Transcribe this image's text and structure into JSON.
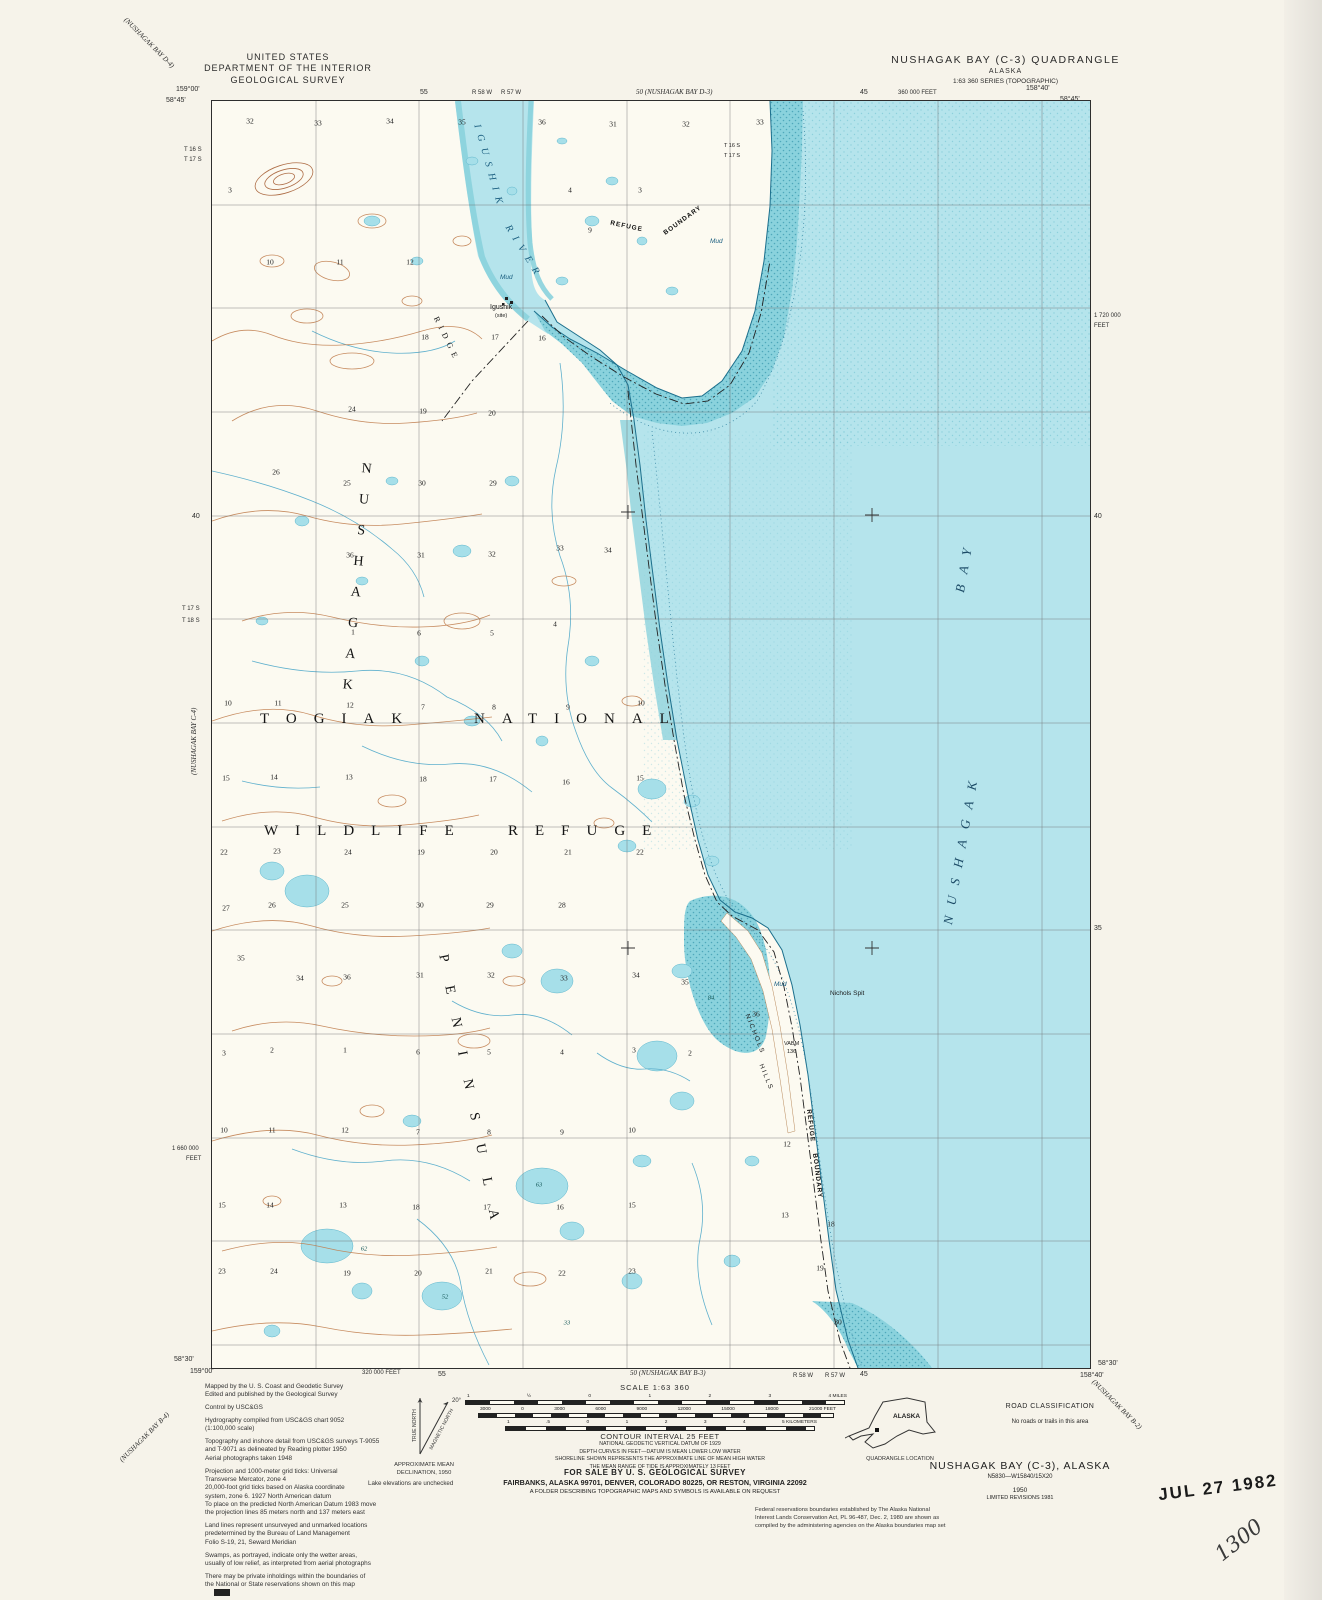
{
  "header": {
    "agency_line1": "UNITED STATES",
    "agency_line2": "DEPARTMENT OF THE INTERIOR",
    "agency_line3": "GEOLOGICAL SURVEY",
    "quad_title": "NUSHAGAK BAY (C-3) QUADRANGLE",
    "quad_state": "ALASKA",
    "quad_series": "1:63 360 SERIES (TOPOGRAPHIC)"
  },
  "edges": {
    "top_left_adjoining": "(NUSHAGAK BAY D-4)",
    "top_left_lon": "159°00'",
    "top_left_lat": "58°45'",
    "top_tick_55": "55",
    "top_range_1": "R 58 W",
    "top_range_2": "R 57 W",
    "top_center_adjoining": "50 (NUSHAGAK BAY D-3)",
    "top_tick_45": "45",
    "top_feet": "360 000 FEET",
    "top_right_lon": "158°40'",
    "top_right_lat": "58°45'",
    "left_township_1": "T 16 S",
    "left_township_2": "T 17 S",
    "left_tick_40": "40",
    "left_township_3": "T 17 S",
    "left_township_4": "T 18 S",
    "left_adjoining": "(NUSHAGAK BAY C-4)",
    "left_feet_1": "1 660 000",
    "left_feet_2": "FEET",
    "right_feet_1": "1 720 000",
    "right_feet_2": "FEET",
    "right_tick_40": "40",
    "right_tick_35": "35",
    "bottom_left_lat": "58°30'",
    "bottom_left_lon": "159°00'",
    "bottom_left_adjoining": "(NUSHAGAK BAY B-4)",
    "bottom_feet": "320 000 FEET",
    "bottom_tick_55": "55",
    "bottom_center_adjoining": "50 (NUSHAGAK BAY B-3)",
    "bottom_range_1": "R 58 W",
    "bottom_range_2": "R 57 W",
    "bottom_tick_45": "45",
    "bottom_right_lon": "158°40'",
    "bottom_right_lat": "58°30'",
    "bottom_right_adjoining": "(NUSHAGAK BAY B-2)",
    "imprint": "INTERIOR—GEOLOGICAL SURVEY, RESTON, VIRGINIA—1981"
  },
  "map": {
    "area_label_1": "TOGIAK",
    "area_label_2": "NATIONAL",
    "area_label_3": "WILDLIFE",
    "area_label_4": "REFUGE",
    "peninsula_label_1": "NUSHAGAK",
    "peninsula_label_2": "PENINSULA",
    "bay_label_1": "NUSHAGAK",
    "bay_label_2": "BAY",
    "river_label_1": "IGUSHIK",
    "river_label_2": "RIVER",
    "ridge_label": "RIDGE",
    "boundary_top_1": "REFUGE",
    "boundary_top_2": "BOUNDARY",
    "boundary_coast_1": "REFUGE",
    "boundary_coast_2": "BOUNDARY",
    "nichols_spit": "Nichols Spit",
    "nichols_hills_1": "NICHOLS",
    "nichols_hills_2": "HILLS",
    "vabm_line1": "VABM",
    "vabm_line2": "136",
    "site_name": "Igushik",
    "site_type": "(site)",
    "mud_label": "Mud",
    "township_inside_1": "T 16 S",
    "township_inside_2": "T 17 S",
    "sections": [
      {
        "n": "32",
        "x": 38,
        "y": 20
      },
      {
        "n": "33",
        "x": 106,
        "y": 22
      },
      {
        "n": "34",
        "x": 178,
        "y": 20
      },
      {
        "n": "35",
        "x": 250,
        "y": 21
      },
      {
        "n": "36",
        "x": 330,
        "y": 21
      },
      {
        "n": "31",
        "x": 401,
        "y": 23
      },
      {
        "n": "32",
        "x": 474,
        "y": 23
      },
      {
        "n": "33",
        "x": 548,
        "y": 21
      },
      {
        "n": "3",
        "x": 18,
        "y": 89
      },
      {
        "n": "4",
        "x": 358,
        "y": 89
      },
      {
        "n": "3",
        "x": 428,
        "y": 89
      },
      {
        "n": "9",
        "x": 378,
        "y": 129
      },
      {
        "n": "10",
        "x": 58,
        "y": 161
      },
      {
        "n": "11",
        "x": 128,
        "y": 161
      },
      {
        "n": "12",
        "x": 198,
        "y": 161
      },
      {
        "n": "18",
        "x": 213,
        "y": 236
      },
      {
        "n": "17",
        "x": 283,
        "y": 236
      },
      {
        "n": "16",
        "x": 330,
        "y": 237
      },
      {
        "n": "24",
        "x": 140,
        "y": 308
      },
      {
        "n": "19",
        "x": 211,
        "y": 310
      },
      {
        "n": "20",
        "x": 280,
        "y": 312
      },
      {
        "n": "26",
        "x": 64,
        "y": 371
      },
      {
        "n": "25",
        "x": 135,
        "y": 382
      },
      {
        "n": "30",
        "x": 210,
        "y": 382
      },
      {
        "n": "29",
        "x": 281,
        "y": 382
      },
      {
        "n": "36",
        "x": 138,
        "y": 454
      },
      {
        "n": "31",
        "x": 209,
        "y": 454
      },
      {
        "n": "32",
        "x": 280,
        "y": 453
      },
      {
        "n": "33",
        "x": 348,
        "y": 447
      },
      {
        "n": "34",
        "x": 396,
        "y": 449
      },
      {
        "n": "1",
        "x": 141,
        "y": 531
      },
      {
        "n": "6",
        "x": 207,
        "y": 532
      },
      {
        "n": "5",
        "x": 280,
        "y": 532
      },
      {
        "n": "4",
        "x": 343,
        "y": 523
      },
      {
        "n": "10",
        "x": 16,
        "y": 602
      },
      {
        "n": "11",
        "x": 66,
        "y": 602
      },
      {
        "n": "12",
        "x": 138,
        "y": 604
      },
      {
        "n": "7",
        "x": 211,
        "y": 606
      },
      {
        "n": "8",
        "x": 282,
        "y": 606
      },
      {
        "n": "9",
        "x": 356,
        "y": 606
      },
      {
        "n": "10",
        "x": 429,
        "y": 602
      },
      {
        "n": "15",
        "x": 14,
        "y": 677
      },
      {
        "n": "14",
        "x": 62,
        "y": 676
      },
      {
        "n": "13",
        "x": 137,
        "y": 676
      },
      {
        "n": "18",
        "x": 211,
        "y": 678
      },
      {
        "n": "17",
        "x": 281,
        "y": 678
      },
      {
        "n": "16",
        "x": 354,
        "y": 681
      },
      {
        "n": "15",
        "x": 428,
        "y": 677
      },
      {
        "n": "22",
        "x": 12,
        "y": 751
      },
      {
        "n": "23",
        "x": 65,
        "y": 750
      },
      {
        "n": "24",
        "x": 136,
        "y": 751
      },
      {
        "n": "19",
        "x": 209,
        "y": 751
      },
      {
        "n": "20",
        "x": 282,
        "y": 751
      },
      {
        "n": "21",
        "x": 356,
        "y": 751
      },
      {
        "n": "22",
        "x": 428,
        "y": 751
      },
      {
        "n": "27",
        "x": 14,
        "y": 807
      },
      {
        "n": "26",
        "x": 60,
        "y": 804
      },
      {
        "n": "25",
        "x": 133,
        "y": 804
      },
      {
        "n": "30",
        "x": 208,
        "y": 804
      },
      {
        "n": "29",
        "x": 278,
        "y": 804
      },
      {
        "n": "28",
        "x": 350,
        "y": 804
      },
      {
        "n": "35",
        "x": 29,
        "y": 857
      },
      {
        "n": "34",
        "x": 88,
        "y": 877
      },
      {
        "n": "36",
        "x": 135,
        "y": 876
      },
      {
        "n": "31",
        "x": 208,
        "y": 874
      },
      {
        "n": "32",
        "x": 279,
        "y": 874
      },
      {
        "n": "33",
        "x": 352,
        "y": 877
      },
      {
        "n": "34",
        "x": 424,
        "y": 874
      },
      {
        "n": "35",
        "x": 473,
        "y": 881
      },
      {
        "n": "36",
        "x": 544,
        "y": 913
      },
      {
        "n": "3",
        "x": 12,
        "y": 952
      },
      {
        "n": "2",
        "x": 60,
        "y": 949
      },
      {
        "n": "1",
        "x": 133,
        "y": 949
      },
      {
        "n": "6",
        "x": 206,
        "y": 951
      },
      {
        "n": "5",
        "x": 277,
        "y": 951
      },
      {
        "n": "4",
        "x": 350,
        "y": 951
      },
      {
        "n": "3",
        "x": 422,
        "y": 949
      },
      {
        "n": "2",
        "x": 478,
        "y": 952
      },
      {
        "n": "10",
        "x": 12,
        "y": 1029
      },
      {
        "n": "11",
        "x": 60,
        "y": 1029
      },
      {
        "n": "12",
        "x": 133,
        "y": 1029
      },
      {
        "n": "7",
        "x": 206,
        "y": 1031
      },
      {
        "n": "8",
        "x": 277,
        "y": 1031
      },
      {
        "n": "9",
        "x": 350,
        "y": 1031
      },
      {
        "n": "10",
        "x": 420,
        "y": 1029
      },
      {
        "n": "12",
        "x": 575,
        "y": 1043
      },
      {
        "n": "15",
        "x": 10,
        "y": 1104
      },
      {
        "n": "14",
        "x": 58,
        "y": 1104
      },
      {
        "n": "13",
        "x": 131,
        "y": 1104
      },
      {
        "n": "18",
        "x": 204,
        "y": 1106
      },
      {
        "n": "17",
        "x": 275,
        "y": 1106
      },
      {
        "n": "16",
        "x": 348,
        "y": 1106
      },
      {
        "n": "15",
        "x": 420,
        "y": 1104
      },
      {
        "n": "13",
        "x": 573,
        "y": 1114
      },
      {
        "n": "18",
        "x": 619,
        "y": 1123
      },
      {
        "n": "23",
        "x": 10,
        "y": 1170
      },
      {
        "n": "24",
        "x": 62,
        "y": 1170
      },
      {
        "n": "19",
        "x": 135,
        "y": 1172
      },
      {
        "n": "20",
        "x": 206,
        "y": 1172
      },
      {
        "n": "21",
        "x": 277,
        "y": 1170
      },
      {
        "n": "22",
        "x": 350,
        "y": 1172
      },
      {
        "n": "23",
        "x": 420,
        "y": 1170
      },
      {
        "n": "19",
        "x": 608,
        "y": 1167
      },
      {
        "n": "30",
        "x": 626,
        "y": 1221
      }
    ],
    "spot_elevations": [
      {
        "v": "84",
        "x": 499,
        "y": 897
      },
      {
        "v": "62",
        "x": 152,
        "y": 1148
      },
      {
        "v": "63",
        "x": 327,
        "y": 1084
      },
      {
        "v": "52",
        "x": 233,
        "y": 1196
      },
      {
        "v": "33",
        "x": 355,
        "y": 1222
      }
    ]
  },
  "footer": {
    "scale_label": "SCALE 1:63 360",
    "miles_labels": [
      "1",
      "½",
      "0",
      "1",
      "2",
      "3",
      "4 MILES"
    ],
    "feet_labels": [
      "3000",
      "0",
      "3000",
      "6000",
      "9000",
      "12000",
      "15000",
      "18000",
      "21000 FEET"
    ],
    "km_labels": [
      "1",
      ".5",
      "0",
      "1",
      "2",
      "3",
      "4",
      "5 KILOMETERS"
    ],
    "contour_lines": [
      "NATIONAL GEODETIC VERTICAL DATUM OF 1929",
      "DEPTH CURVES IN FEET—DATUM IS MEAN LOWER LOW WATER",
      "SHORELINE SHOWN REPRESENTS THE APPROXIMATE LINE OF MEAN HIGH WATER",
      "THE MEAN RANGE OF TIDE IS APPROXIMATELY 13 FEET"
    ],
    "contour_title": "CONTOUR INTERVAL 25 FEET",
    "sale_line1": "FOR SALE BY U. S. GEOLOGICAL SURVEY",
    "sale_line2": "FAIRBANKS, ALASKA 99701, DENVER, COLORADO 80225, OR RESTON, VIRGINIA 22092",
    "sale_line3": "A FOLDER DESCRIBING TOPOGRAPHIC MAPS AND SYMBOLS IS AVAILABLE ON REQUEST",
    "credits": [
      "Mapped by the U. S. Coast and Geodetic Survey\nEdited and published by the Geological Survey",
      "Control by USC&GS",
      "Hydrography compiled from USC&GS chart 9052\n(1:100,000 scale)",
      "Topography and inshore detail from USC&GS surveys T-9055\nand T-9071 as delineated by Reading plotter 1950\nAerial photographs taken 1948",
      "Projection and 1000-meter grid ticks: Universal\nTransverse Mercator, zone 4\n20,000-foot grid ticks based on Alaska coordinate\nsystem, zone 6.  1927 North American datum\nTo place on the predicted North American Datum 1983 move\nthe projection lines 85 meters north and 137 meters east",
      "Land lines represent unsurveyed and unmarked locations\npredetermined by the Bureau of Land Management\nFolio S-19, 21, Seward Meridian",
      "Swamps, as portrayed, indicate only the wetter areas,\nusually of low relief, as interpreted from aerial photographs",
      "There may be private inholdings within the boundaries of\nthe National or State reservations shown on this map"
    ],
    "declination": {
      "true_north": "TRUE NORTH",
      "magnetic_north": "MAGNETIC NORTH",
      "angle": "20°",
      "caption": "APPROXIMATE MEAN\nDECLINATION, 1950"
    },
    "lake_note": "Lake elevations are unchecked",
    "federal_note": "Federal reservations boundaries established by The Alaska National\nInterest Lands Conservation Act, PL 96-487, Dec. 2, 1980 are shown as\ncompiled by the administering agencies on the Alaska boundaries map set",
    "road_class": {
      "title": "ROAD CLASSIFICATION",
      "note": "No roads or trails in this area"
    },
    "quad_location": {
      "label": "ALASKA",
      "caption": "QUADRANGLE LOCATION"
    },
    "title_block": {
      "title": "NUSHAGAK BAY (C-3), ALASKA",
      "code": "N5830—W15840/15X20",
      "year": "1950",
      "revision": "LIMITED REVISIONS 1981"
    },
    "stamp": {
      "date": "JUL 27 1982",
      "number": "1300"
    }
  },
  "colors": {
    "paper": "#f6f3ea",
    "land": "#fcfaf1",
    "water": "#b5e4ec",
    "tidal_flat": "#8ad2dd",
    "lake": "#a6dfe9",
    "stream": "#5fb0cd",
    "contour": "#c17f50",
    "ink": "#2b2b2b"
  }
}
